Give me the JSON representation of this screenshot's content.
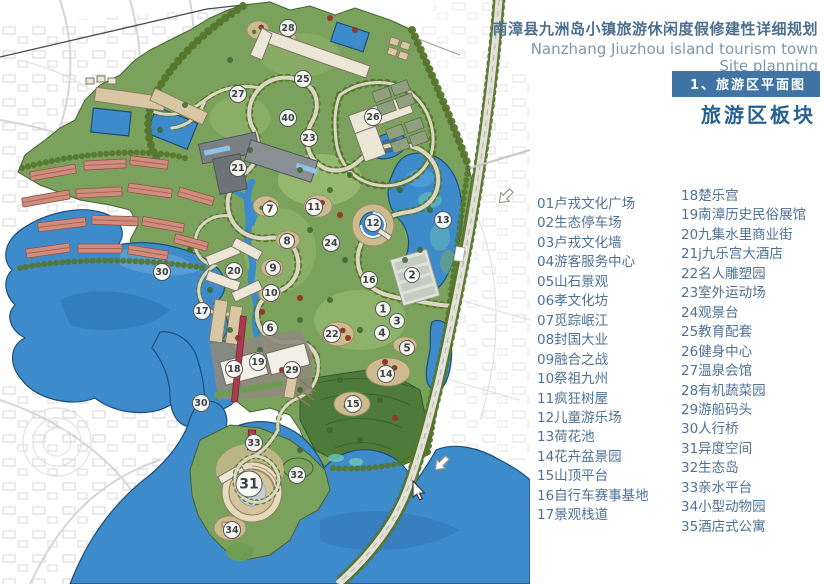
{
  "header": {
    "title_zh": "南漳县九洲岛小镇旅游休闲度假修建性详细规划",
    "title_en_line1": "Nanzhang Jiuzhou island tourism town",
    "title_en_line2": "Site planning",
    "section_banner": "1、旅游区平面图",
    "section_subtitle": "旅游区板块"
  },
  "legend": {
    "left": [
      "01卢戎文化广场",
      "02生态停车场",
      "03卢戎文化墙",
      "04游客服务中心",
      "05山石景观",
      "06孝文化坊",
      "07觅踪岷江",
      "08封国大业",
      "09融合之战",
      "10祭祖九州",
      "11疯狂树屋",
      "12儿童游乐场",
      "13荷花池",
      "14花卉盆景园",
      "15山顶平台",
      "16自行车赛事基地",
      "17景观栈道"
    ],
    "right": [
      "18楚乐宫",
      "19南漳历史民俗展馆",
      "20九集水里商业街",
      "21j九乐宫大酒店",
      "22名人雕塑园",
      "23室外运动场",
      "24观景台",
      "25教育配套",
      "26健身中心",
      "27温泉会馆",
      "28有机蔬菜园",
      "29游船码头",
      "30人行桥",
      "31异度空间",
      "32生态岛",
      "33亲水平台",
      "34小型动物园",
      "35酒店式公寓"
    ]
  },
  "map": {
    "markers": [
      {
        "n": "28",
        "x": 288,
        "y": 28
      },
      {
        "n": "25",
        "x": 303,
        "y": 79
      },
      {
        "n": "27",
        "x": 238,
        "y": 94
      },
      {
        "n": "26",
        "x": 373,
        "y": 117
      },
      {
        "n": "40",
        "x": 288,
        "y": 118
      },
      {
        "n": "23",
        "x": 309,
        "y": 138
      },
      {
        "n": "21",
        "x": 238,
        "y": 168
      },
      {
        "n": "11",
        "x": 314,
        "y": 207
      },
      {
        "n": "7",
        "x": 270,
        "y": 209
      },
      {
        "n": "13",
        "x": 443,
        "y": 220
      },
      {
        "n": "12",
        "x": 373,
        "y": 223
      },
      {
        "n": "8",
        "x": 287,
        "y": 241
      },
      {
        "n": "24",
        "x": 331,
        "y": 243
      },
      {
        "n": "9",
        "x": 273,
        "y": 268
      },
      {
        "n": "20",
        "x": 234,
        "y": 271
      },
      {
        "n": "30",
        "x": 162,
        "y": 272
      },
      {
        "n": "2",
        "x": 412,
        "y": 275
      },
      {
        "n": "16",
        "x": 369,
        "y": 280
      },
      {
        "n": "10",
        "x": 271,
        "y": 293
      },
      {
        "n": "1",
        "x": 383,
        "y": 309
      },
      {
        "n": "17",
        "x": 202,
        "y": 311
      },
      {
        "n": "3",
        "x": 397,
        "y": 321
      },
      {
        "n": "6",
        "x": 270,
        "y": 328
      },
      {
        "n": "4",
        "x": 382,
        "y": 333
      },
      {
        "n": "22",
        "x": 332,
        "y": 334
      },
      {
        "n": "5",
        "x": 407,
        "y": 348
      },
      {
        "n": "19",
        "x": 258,
        "y": 362
      },
      {
        "n": "18",
        "x": 234,
        "y": 369
      },
      {
        "n": "29",
        "x": 292,
        "y": 370
      },
      {
        "n": "14",
        "x": 386,
        "y": 374
      },
      {
        "n": "30",
        "x": 201,
        "y": 403
      },
      {
        "n": "15",
        "x": 353,
        "y": 404
      },
      {
        "n": "33",
        "x": 254,
        "y": 443
      },
      {
        "n": "32",
        "x": 297,
        "y": 475
      },
      {
        "n": "31",
        "x": 249,
        "y": 484,
        "r": 13
      },
      {
        "n": "34",
        "x": 232,
        "y": 530
      }
    ],
    "icons": [
      "direction-arrow-icon",
      "cursor-pointer-icon"
    ]
  },
  "colors": {
    "banner_bg": "#3f74a4",
    "title_text": "#4d6f8f",
    "subtitle_text": "#27618e",
    "legend_text": "#4e7296",
    "water": "#3e8bcb",
    "site_green": "#7ba25d"
  }
}
